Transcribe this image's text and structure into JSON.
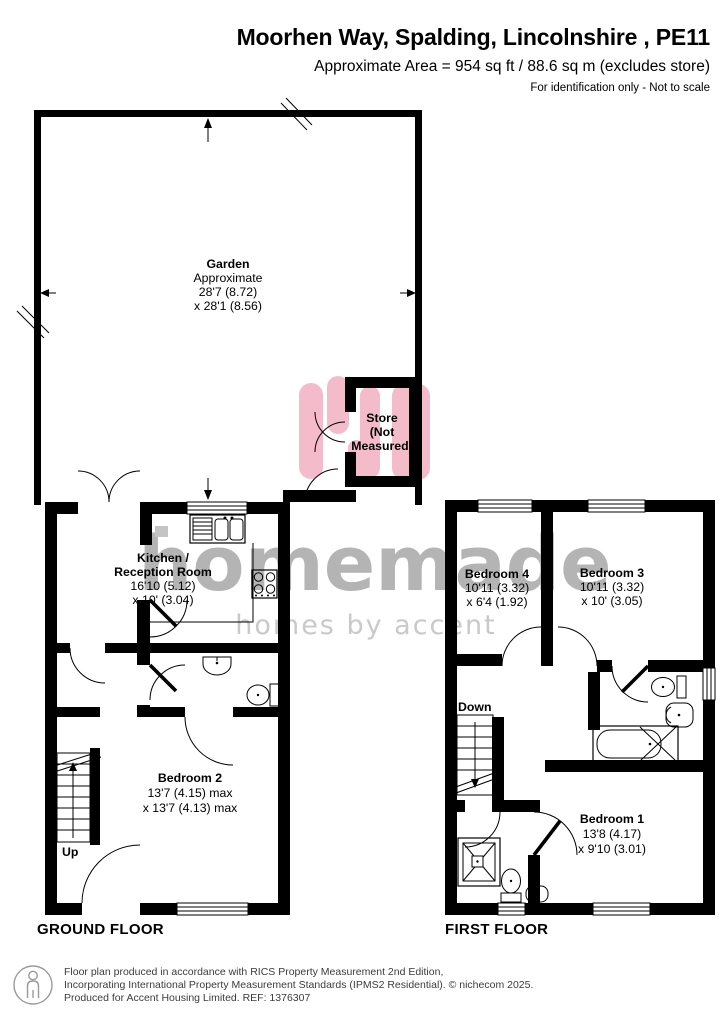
{
  "header": {
    "title": "Moorhen Way, Spalding, Lincolnshire , PE11",
    "area_line": "Approximate Area = 954 sq ft / 88.6 sq m (excludes store)",
    "disclaimer": "For identification only - Not to scale"
  },
  "ground_floor": {
    "label": "GROUND FLOOR",
    "garden": {
      "name": "Garden",
      "lines": [
        "Approximate",
        "28'7 (8.72)",
        "x 28'1 (8.56)"
      ]
    },
    "store": {
      "lines": [
        "Store",
        "(Not",
        "Measured)"
      ]
    },
    "kitchen": {
      "name_lines": [
        "Kitchen /",
        "Reception Room"
      ],
      "dims": [
        "16'10 (5.12)",
        "x 10' (3.04)"
      ]
    },
    "bedroom2": {
      "name": "Bedroom 2",
      "dims": [
        "13'7 (4.15) max",
        "x 13'7 (4.13) max"
      ]
    },
    "stairs_label": "Up"
  },
  "first_floor": {
    "label": "FIRST FLOOR",
    "bedroom4": {
      "name": "Bedroom 4",
      "dims": [
        "10'11 (3.32)",
        "x 6'4 (1.92)"
      ]
    },
    "bedroom3": {
      "name": "Bedroom 3",
      "dims": [
        "10'11 (3.32)",
        "x 10' (3.05)"
      ]
    },
    "bedroom1": {
      "name": "Bedroom 1",
      "dims": [
        "13'8 (4.17)",
        "x 9'10 (3.01)"
      ]
    },
    "stairs_label": "Down"
  },
  "watermark": {
    "brand": "homemade",
    "tagline": "homes by accent"
  },
  "footer": {
    "lines": [
      "Floor plan produced in accordance with RICS Property Measurement 2nd Edition,",
      "Incorporating International Property Measurement Standards (IPMS2 Residential).   © nichecom 2025.",
      "Produced for Accent Housing Limited.   REF: 1376307"
    ]
  },
  "colors": {
    "wall": "#000000",
    "watermark_text": "#b4b4b4",
    "watermark_tagline": "#c9c9c9",
    "brand_pink": "#f4bcca"
  }
}
